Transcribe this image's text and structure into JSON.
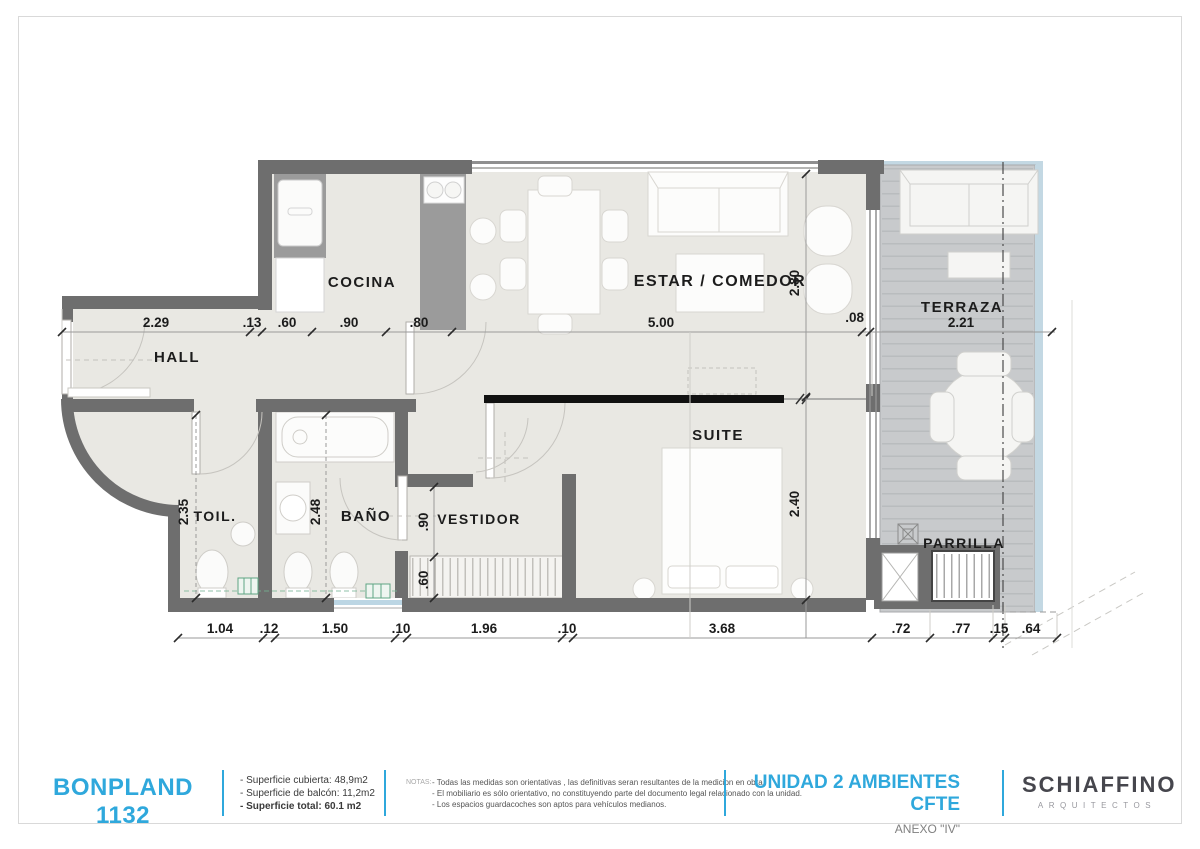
{
  "accent_blue": "#2fa8dc",
  "plan": {
    "labels": {
      "hall": "HALL",
      "cocina": "COCINA",
      "toil": "TOIL.",
      "bano": "BAÑO",
      "vestidor": "VESTIDOR",
      "suite": "SUITE",
      "estar": "ESTAR / COMEDOR",
      "terraza": "TERRAZA",
      "parrilla": "PARRILLA"
    },
    "dims_top": [
      "2.29",
      ".13",
      ".60",
      ".90",
      ".80",
      "5.00",
      ".08",
      "2.21"
    ],
    "dims_bottom": [
      "1.04",
      ".12",
      "1.50",
      ".10",
      "1.96",
      ".10",
      "3.68",
      ".72",
      ".77",
      ".15",
      ".64"
    ],
    "dims_side": {
      "toil_depth": "2.35",
      "bano_depth": "2.48",
      "vestidor_opening": ".90",
      "closet_depth": ".60",
      "estar_width": "2.80",
      "suite_width": "2.40"
    }
  },
  "footer": {
    "project": "BONPLAND 1132",
    "areas": [
      "- Superficie cubierta: 48,9m2",
      "- Superficie de balcón: 11,2m2",
      "- Superficie total: 60.1 m2"
    ],
    "notes_label": "NOTAS:",
    "notes": [
      "- Todas las medidas son orientativas , las definitivas seran resultantes de la medicion en obra.",
      "- El mobiliario es sólo orientativo, no constituyendo parte del documento legal relacionado con la unidad.",
      "- Los espacios guardacoches son aptos para vehículos medianos."
    ],
    "unit_title": "UNIDAD 2 AMBIENTES CFTE",
    "annex": "ANEXO \"IV\"",
    "firm_name": "SCHIAFFINO",
    "firm_sub": "ARQUITECTOS"
  }
}
